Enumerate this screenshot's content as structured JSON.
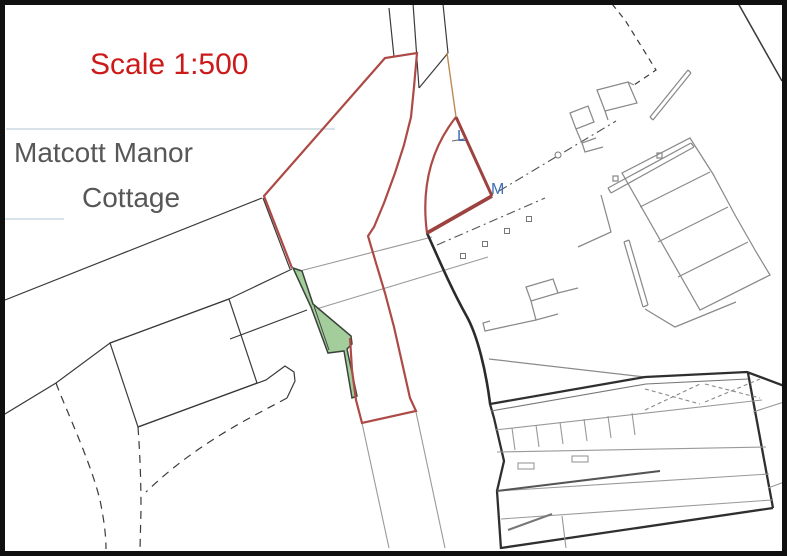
{
  "page": {
    "title": "Site location plan scan"
  },
  "map": {
    "scale_label": "Scale 1:500",
    "place_name_line1": "Matcott Manor",
    "place_name_line2": "Cottage",
    "marker_l": "L",
    "marker_m": "M"
  },
  "colors": {
    "boundary_red": "#ad4a46",
    "boundary_red_thick": "#9c4340",
    "scale_text_red": "#cc1a1a",
    "label_gray": "#575757",
    "marker_blue": "#3c6fb6",
    "area_green_fill": "#93c489",
    "area_green_stroke": "#3a443a",
    "line_black": "#3a3a3a",
    "line_gray": "#8a8a8a",
    "line_light_gray": "#9a9a9a",
    "frame_black": "#101010",
    "artifact_blue": "#ccd9e2"
  }
}
